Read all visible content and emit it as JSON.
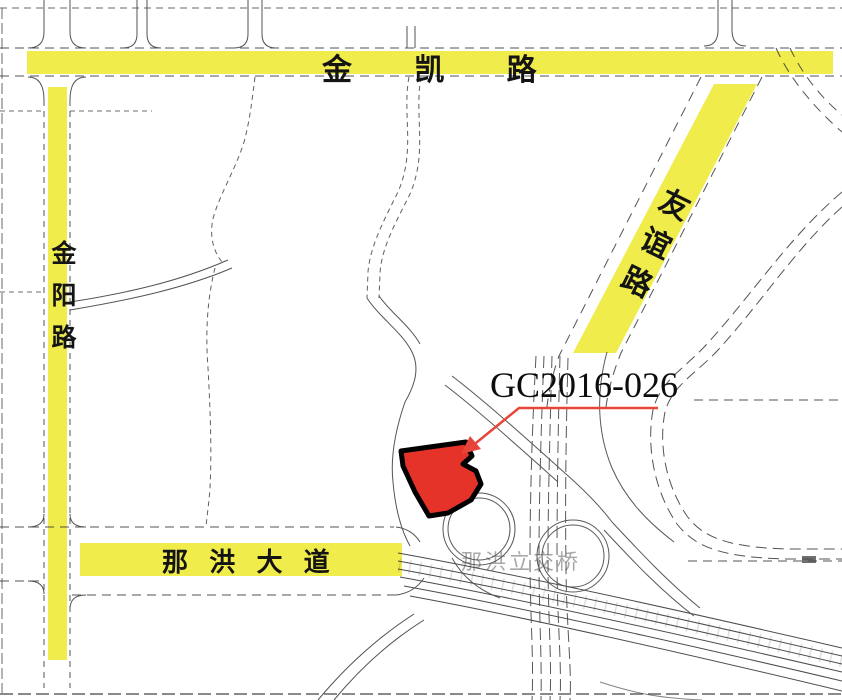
{
  "map": {
    "roads": {
      "jinkai_label": "金 凯 路",
      "jinyang_label": "金阳路",
      "youyi_label": "友谊路",
      "nahong_label": "那 洪 大 道"
    },
    "parcel": {
      "code": "GC2016-026"
    },
    "interchange": {
      "label": "那洪立交桥"
    },
    "colors": {
      "highlight_yellow": "#f0ec4b",
      "parcel_red": "#e6332a",
      "leader_red": "#e8453a",
      "road_line": "#3c3c3c"
    }
  }
}
